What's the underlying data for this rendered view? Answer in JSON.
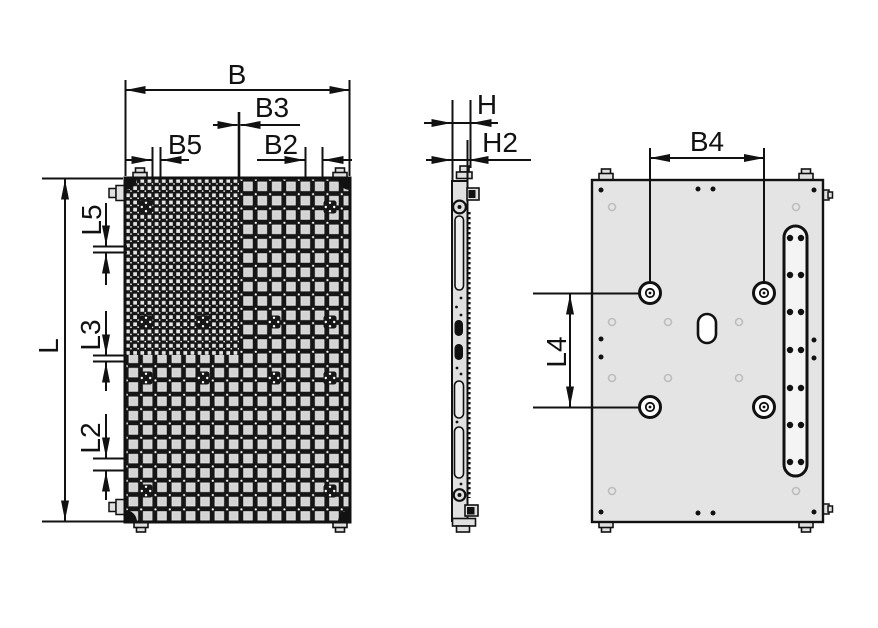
{
  "drawing": {
    "title": "vacuum-gripping-plate-three-view-dimension-drawing",
    "labels": {
      "B": "B",
      "B2": "B2",
      "B3": "B3",
      "B4": "B4",
      "B5": "B5",
      "L": "L",
      "L2": "L2",
      "L3": "L3",
      "L4": "L4",
      "L5": "L5",
      "H": "H",
      "H2": "H2"
    },
    "colors": {
      "line": "#111111",
      "plate_gray": "#e4e4e4",
      "cell_gray": "#dcdcdc",
      "faint_mark": "#bdbdbd",
      "background": "#ffffff"
    }
  }
}
